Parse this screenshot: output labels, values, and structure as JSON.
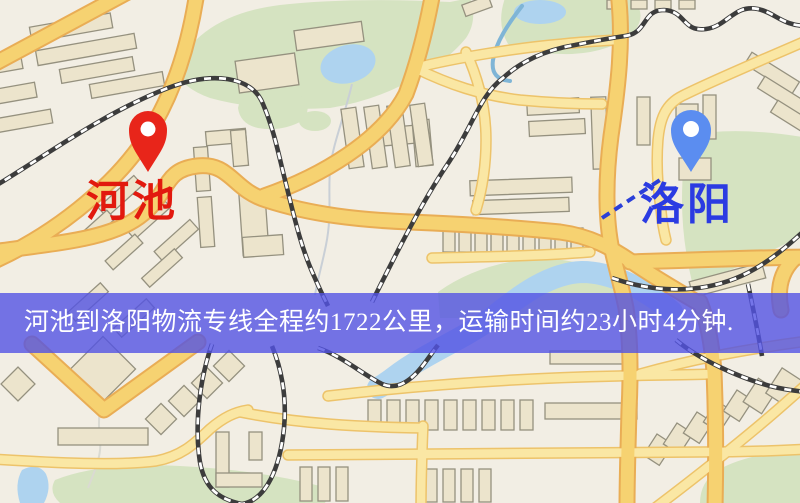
{
  "banner": {
    "text": "河池到洛阳物流专线全程约1722公里，运输时间约23小时4分钟."
  },
  "markers": {
    "origin": {
      "label": "河池",
      "label_color": "#e2190e",
      "pin_color": "#e8251a",
      "pin_hole_color": "#ffffff"
    },
    "destination": {
      "label": "洛阳",
      "label_color": "#2b3be2",
      "pin_color": "#5b8df0",
      "pin_hole_color": "#ffffff"
    }
  },
  "map": {
    "palette": {
      "background": "#f2eee4",
      "green": "#d5e3c1",
      "water": "#aed3ef",
      "road_minor": "#fae7a4",
      "road_minor_casing": "#edc36a",
      "road_major": "#f6d271",
      "road_major_casing": "#e9ad55",
      "building": "#ece4cc",
      "building_stroke": "#95917f",
      "railway": "#3c3c3c",
      "metro_line": "#2b3fd8",
      "banner_overlay": "#5252e4"
    }
  }
}
